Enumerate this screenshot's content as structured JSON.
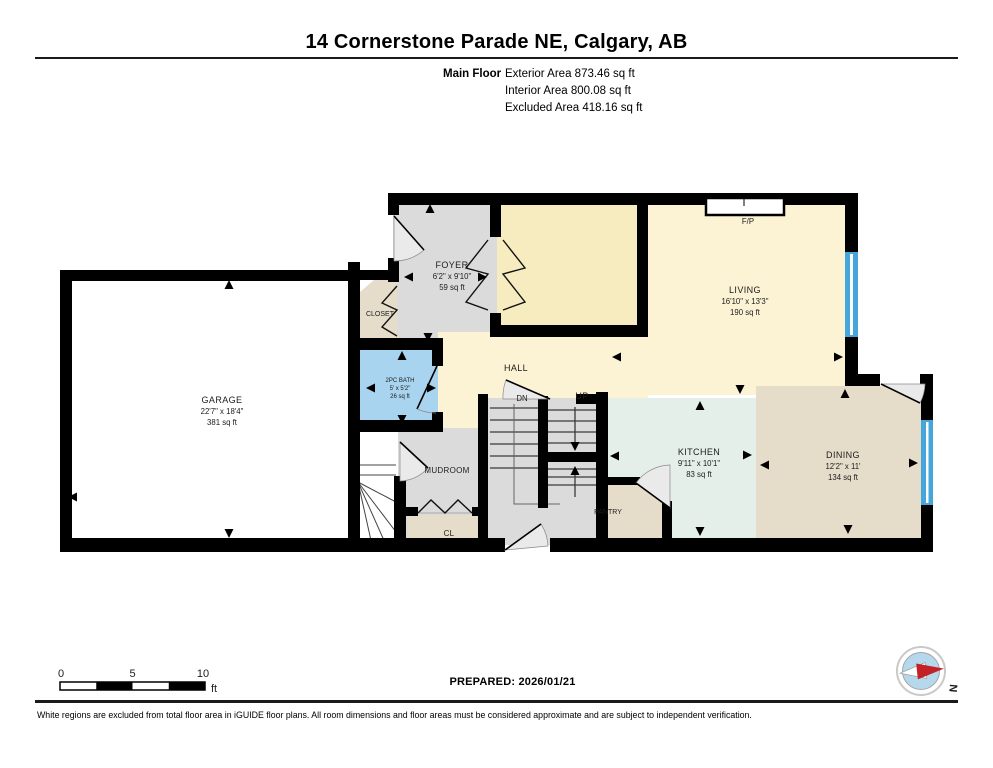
{
  "header": {
    "title": "14 Cornerstone Parade NE, Calgary, AB",
    "floor_label": "Main Floor",
    "exterior_area": "Exterior Area 873.46 sq ft",
    "interior_area": "Interior Area 800.08 sq ft",
    "excluded_area": "Excluded Area 418.16 sq ft"
  },
  "rooms": {
    "garage": {
      "name": "GARAGE",
      "dims": "22'7\" x 18'4\"",
      "area": "381 sq ft"
    },
    "foyer": {
      "name": "FOYER",
      "dims": "6'2\" x 9'10\"",
      "area": "59 sq ft"
    },
    "closet": {
      "name": "CLOSET"
    },
    "bath": {
      "name": "2PC BATH",
      "dims": "5' x 5'2\"",
      "area": "26 sq ft"
    },
    "hall": {
      "name": "HALL"
    },
    "living": {
      "name": "LIVING",
      "dims": "16'10\" x 13'3\"",
      "area": "190 sq ft"
    },
    "kitchen": {
      "name": "KITCHEN",
      "dims": "9'11\" x 10'1\"",
      "area": "83 sq ft"
    },
    "dining": {
      "name": "DINING",
      "dims": "12'2\" x 11'",
      "area": "134 sq ft"
    },
    "mudroom": {
      "name": "MUDROOM"
    },
    "cl": {
      "name": "CL"
    },
    "pantry": {
      "name": "PANTRY"
    },
    "fireplace": {
      "name": "F/P"
    },
    "stairs": {
      "down": "DN",
      "up": "UP"
    }
  },
  "scale_bar": {
    "tick_0": "0",
    "tick_5": "5",
    "tick_10": "10",
    "unit": "ft"
  },
  "compass": {
    "north_label": "N"
  },
  "footer": {
    "prepared": "PREPARED: 2026/01/21",
    "disclaimer": "White regions are excluded from total floor area in iGUIDE floor plans. All room dimensions and floor areas must be considered approximate and are subject to independent verification."
  },
  "colors": {
    "wall": "#000000",
    "living_fill": "#fbf3d4",
    "flex_room_fill": "#f7ecc0",
    "gray_room_fill": "#dbdbdb",
    "kitchen_fill": "#e5efe9",
    "tan_room_fill": "#e6dcca",
    "bath_fill": "#a9d4ef",
    "window_fill": "#45a6dc",
    "garage_fill": "#ffffff",
    "compass_red": "#c42127",
    "compass_blue": "#b5d8ec"
  }
}
